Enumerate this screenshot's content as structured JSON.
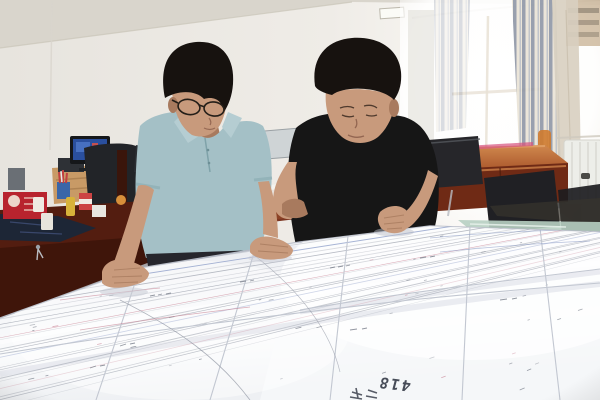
{
  "scene": {
    "figure_label": "418"
  },
  "palette": {
    "wall": "#e9e6e1",
    "wallBright": "#f7f5f1",
    "ceiling": "#d9d5cc",
    "windowGlow": "#ffffff",
    "curtainStripe": "#8b93a3",
    "curtainCream": "#e8e2d4",
    "curtainBeige": "#d8cfc0",
    "buildingTan": "#c7b091",
    "deskDark": "#531d10",
    "deskMid": "#7c3520",
    "tableWood": "#a34a28",
    "woodLight": "#cd8350",
    "chairDark": "#26262a",
    "chairFrame": "#a05c2e",
    "monitorBlue": "#2a4f9e",
    "paper": "#f6f7f9",
    "paperShadow": "#dde0e8",
    "seamGray": "#c2c7d1",
    "lineInk": "#6f7582",
    "lineGray": "#8d93a0",
    "lineRed": "#c4798c",
    "lineBlue": "#7d8fc0",
    "skin": "#c89a7c",
    "skinShadow": "#a87a5e",
    "hair": "#17120f",
    "shirtBlue": "#a4c0c6",
    "shirtBlack": "#161616",
    "trousers": "#26262c",
    "glassGreen": "#b7cfc2",
    "radiator": "#edeee9",
    "folderRed": "#c22836",
    "accentPink": "#d6527e",
    "labelInk": "#474c58"
  }
}
